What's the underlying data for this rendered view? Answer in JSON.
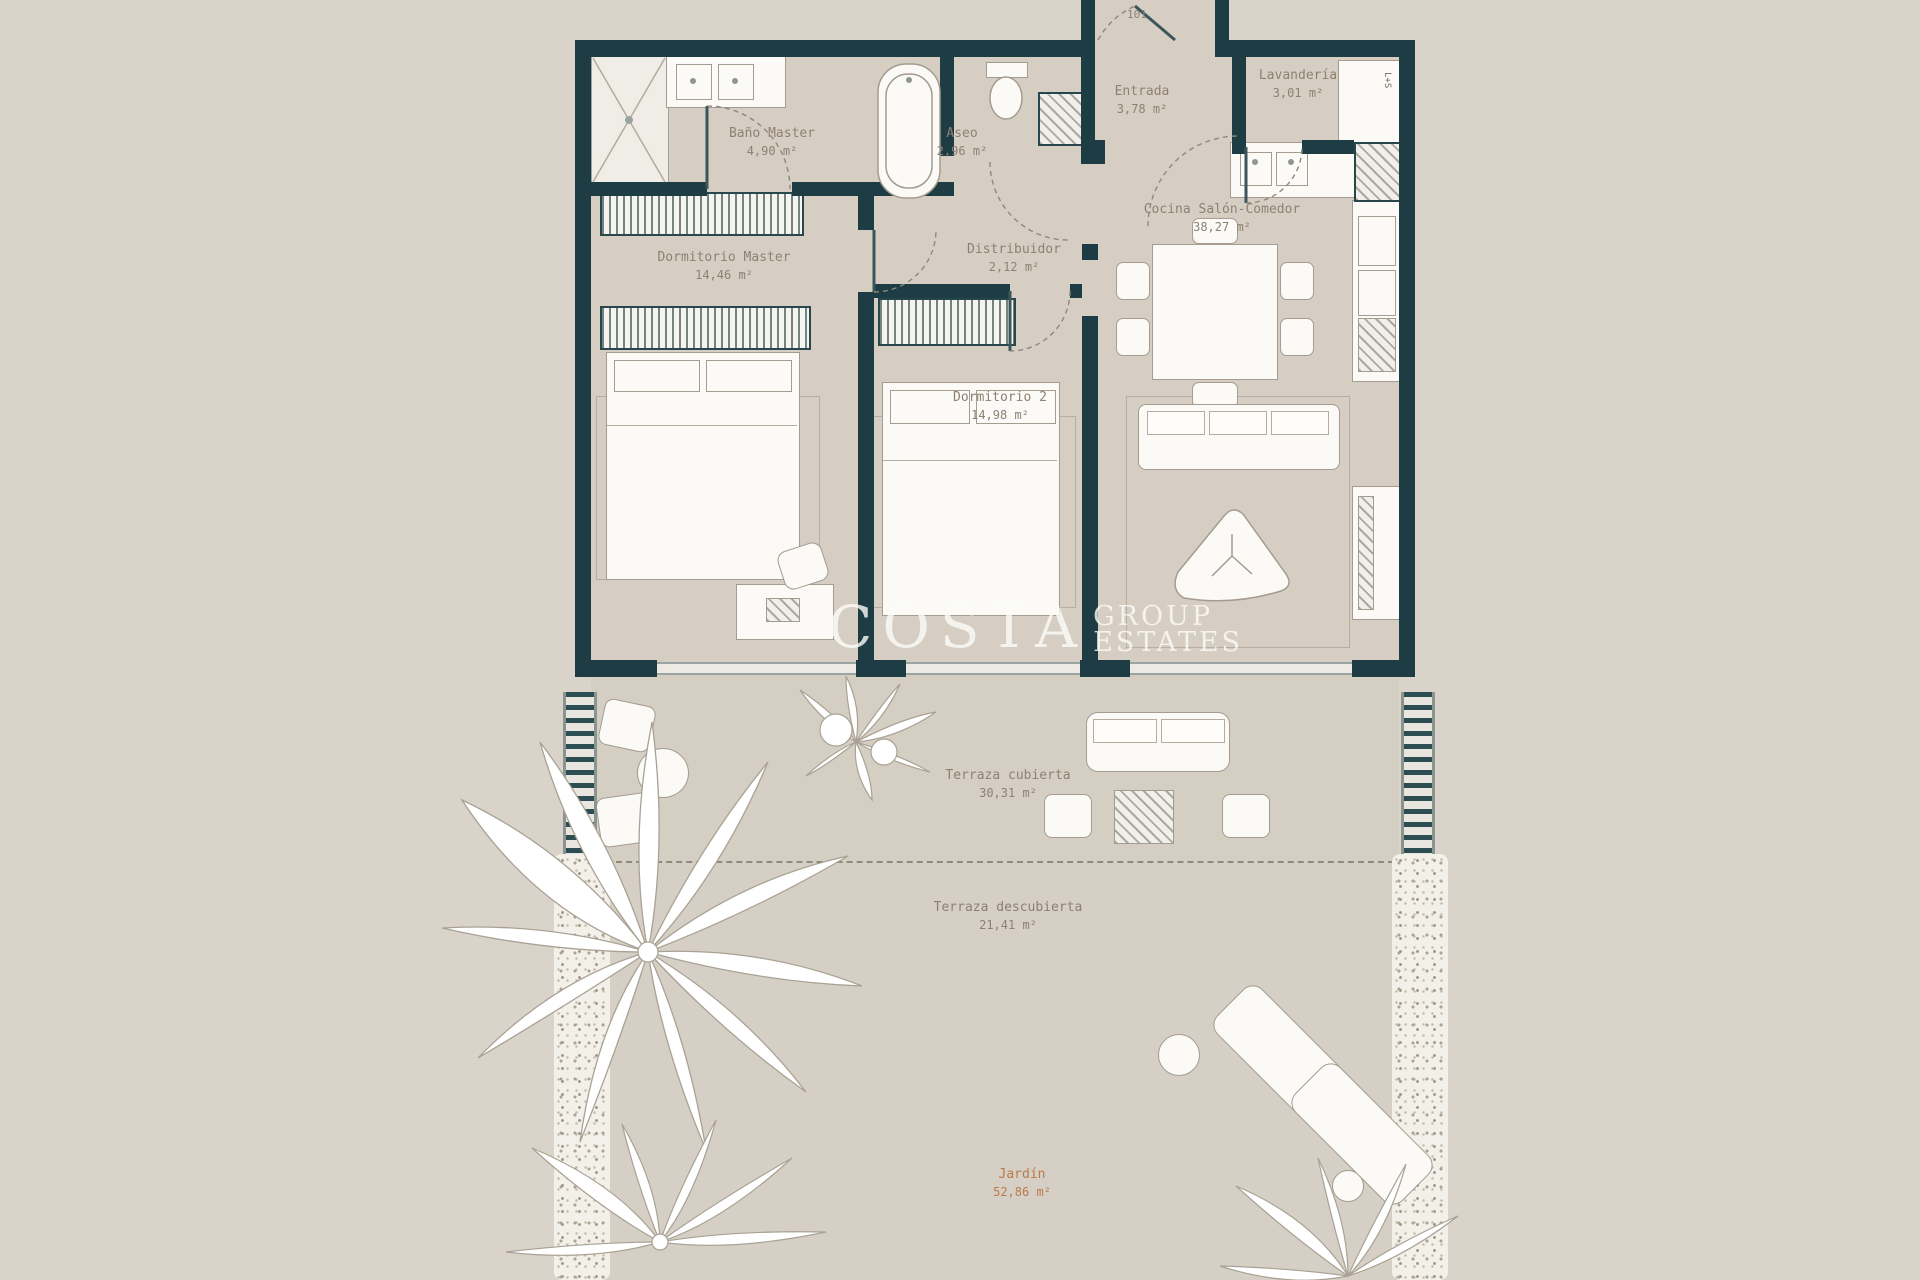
{
  "plan": {
    "door_number": "101",
    "appliance_label": "L+S",
    "watermark": {
      "main": "COSTA",
      "sub1": "GROUP",
      "sub2": "ESTATES"
    }
  },
  "rooms": [
    {
      "id": "bano-master",
      "name": "Baño Master",
      "area": "4,90 m²"
    },
    {
      "id": "dormitorio-master",
      "name": "Dormitorio Master",
      "area": "14,46 m²"
    },
    {
      "id": "aseo",
      "name": "Aseo",
      "area": "2,96 m²"
    },
    {
      "id": "entrada",
      "name": "Entrada",
      "area": "3,78 m²"
    },
    {
      "id": "lavanderia",
      "name": "Lavandería",
      "area": "3,01 m²"
    },
    {
      "id": "cocina-salon",
      "name": "Cocina Salón-Comedor",
      "area": "38,27 m²"
    },
    {
      "id": "distribuidor",
      "name": "Distribuidor",
      "area": "2,12 m²"
    },
    {
      "id": "dormitorio-2",
      "name": "Dormitorio 2",
      "area": "14,98 m²"
    },
    {
      "id": "terraza-cubierta",
      "name": "Terraza cubierta",
      "area": "30,31 m²"
    },
    {
      "id": "terraza-descubierta",
      "name": "Terraza descubierta",
      "area": "21,41 m²"
    },
    {
      "id": "jardin",
      "name": "Jardín",
      "area": "52,86 m²"
    }
  ],
  "colors": {
    "wall": "#1e3c43",
    "floor": "#d6cec2",
    "background": "#d9d3c9",
    "label_text": "#8d8174",
    "accent_orange": "#bc7a4b",
    "furniture_stroke": "#a39c8f",
    "glazing": "#9aa5a3"
  }
}
